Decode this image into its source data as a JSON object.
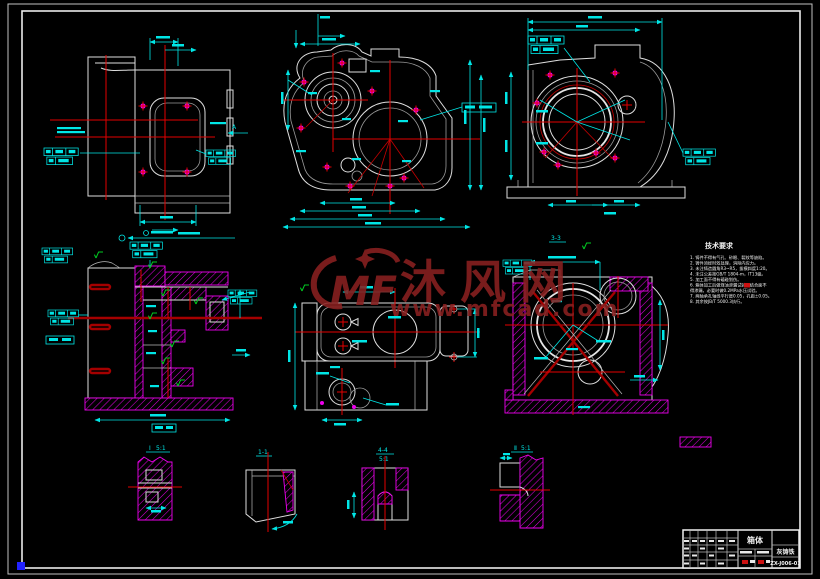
{
  "colors": {
    "background": "#000000",
    "outline_white": "#dedede",
    "dimension_cyan": "#00e6e6",
    "centerline_red": "#e30000",
    "hatch_magenta": "#ee00ee",
    "finish_green": "#00cc22",
    "watermark_maroon": "#8a2020",
    "grip_blue": "#2222ff"
  },
  "watermark": {
    "logo_text": "MF",
    "site_name": "沐风网",
    "site_url": "www.mfcad.com"
  },
  "tech_requirements": {
    "title": "技术要求",
    "lines": [
      "1. 铸件不得有气孔、砂眼、裂纹等缺陷。",
      "2. 铸件须经时效处理，消除内应力。",
      "3. 未注铸造圆角R3~R5，拔模斜度1:20。",
      "4. 未注公差按GB/T 1804-m，IT13级。",
      "5. 加工面不得有磕碰划伤。",
      "6. 箱体加工后做煤油渗漏试验，结合面不",
      "   得渗漏，必要时做0.2MPa水压试验。",
      "7. 两轴承孔轴线平行度0.05，孔距±0.05。",
      "8. 其余按JB/T 5000.3执行。"
    ]
  },
  "labels": {
    "view_arrow_a": "A",
    "section_3_3": "3-3",
    "detail_1_name": "Ⅰ",
    "detail_1_scale": "5:1",
    "detail_2_name": "1-1",
    "detail_3_name": "4-4",
    "detail_3_scale": "5:1",
    "detail_4_name": "Ⅱ",
    "detail_4_scale": "5:1"
  },
  "title_block": {
    "part_name": "箱体",
    "material": "灰铸铁",
    "drawing_no": "ZX-J006-01"
  }
}
